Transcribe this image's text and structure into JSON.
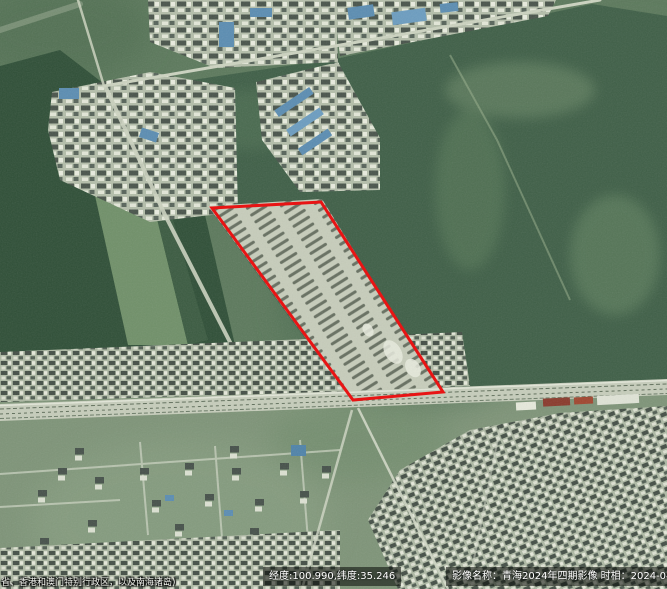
{
  "map": {
    "kind": "satellite-imagery-viewer",
    "colors": {
      "annotation_red": "#e81414",
      "forest_green": "#2f4f37",
      "cropland_green": "#3f5f47",
      "grass_green": "#5c795c",
      "lower_grass": "#7e9478",
      "village_light": "#b4beaa",
      "blue_roof": "#5b8db2",
      "road_light": "#ccd3c0",
      "railway_band": "#c6cdbb",
      "overlay_bg": "rgba(0,0,0,0.55)",
      "overlay_text": "#ffffff"
    },
    "annotation": {
      "shape": "polygon",
      "stroke": "#e81414",
      "stroke_width": 3,
      "points_attr": "212,208 321,202 443,392 353,400"
    }
  },
  "overlays": {
    "coordinates": {
      "text": "经度:100.990,纬度:35.246",
      "longitude": "100.990",
      "latitude": "35.246"
    },
    "imagery": {
      "text": "影像名称：青海2024年四期影像 时相：2024-04-11",
      "name": "青海2024年四期影像",
      "date": "2024-04-11"
    },
    "disclaimer": {
      "text": "省、香港和澳门特别行政区，以及南海诸岛)"
    }
  }
}
